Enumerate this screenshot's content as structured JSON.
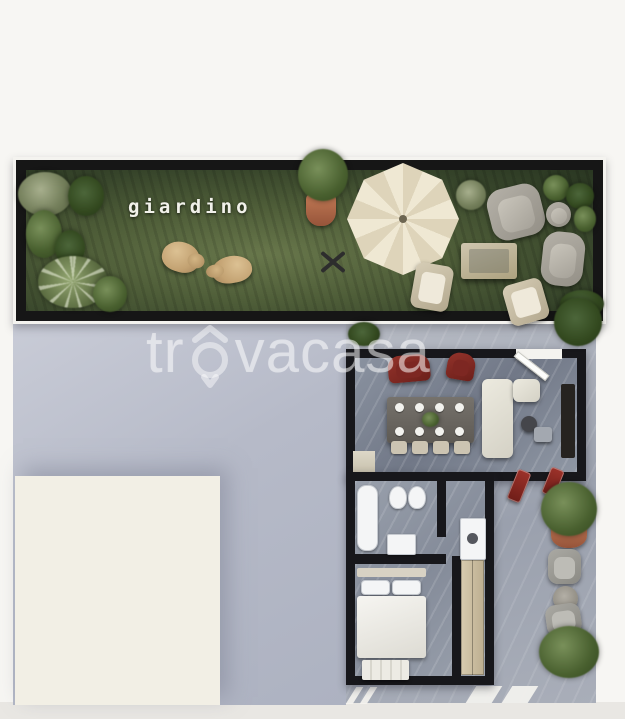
{
  "artwork": {
    "type": "3D top-down apartment floor plan rendering with garden",
    "garden_label": "giardino",
    "watermark": {
      "prefix": "tr",
      "suffix": "vacasa",
      "brand": "trovacasa"
    }
  },
  "palette": {
    "background": "#f7f6f3",
    "garden_grass": "#4e5d38",
    "wall_black": "#17171b",
    "floor_marble_gray": "#8a92a0",
    "neighbor_gray": "#b6bac8",
    "neighbor_roof_cream": "#f2efe5",
    "umbrella_cream": "#e9e1cb",
    "accent_red": "#7d2722",
    "terracotta_pot": "#b1654a",
    "dog_tan": "#c3a272",
    "watermark_white": "rgba(255,255,255,0.46)"
  }
}
